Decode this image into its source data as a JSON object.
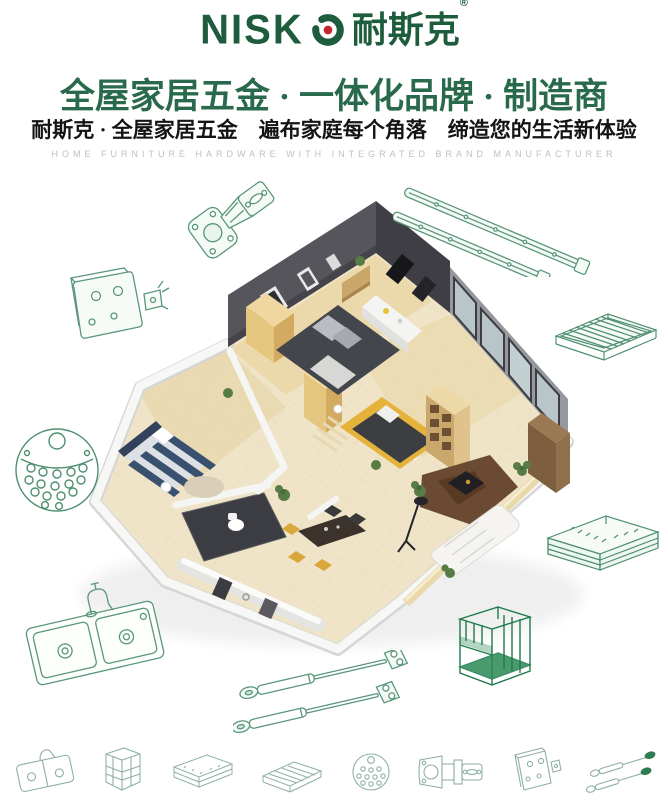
{
  "brand": {
    "logo_letters": "NISK",
    "logo_text": "NISKO",
    "logo_cn": "耐斯克",
    "registered_mark": "®",
    "logo_color": "#1d5c3c",
    "logo_dot_color": "#c1272d"
  },
  "header": {
    "headline": "全屋家居五金 · 一体化品牌 · 制造商",
    "subheadline": "耐斯克 · 全屋家居五金　遍布家庭每个角落　缔造您的生活新体验",
    "tagline": "HOME FURNITURE HARDWARE WITH INTEGRATED BRAND MANUFACTURER",
    "headline_color": "#2a6a4c"
  },
  "illustrations": {
    "line_art_color": "#5a967c",
    "line_art_dark_color": "#1e7a4b",
    "scene": "apartment-3d-cutaway-render",
    "around_scene_icons": [
      "cabinet-hinge-icon",
      "drawer-slides-icon",
      "mounting-bracket-icon",
      "perforated-disc-icon",
      "kitchen-sink-icon",
      "wire-shelf-icon",
      "pullout-basket-icon",
      "wire-rack-organizer-icon",
      "gas-struts-icon"
    ],
    "bottom_row_icons": [
      "sink-mini-icon",
      "cabinet-frame-mini-icon",
      "basket-mini-icon",
      "shelf-mini-icon",
      "disc-mini-icon",
      "hinge-mini-icon",
      "bracket-mini-icon",
      "struts-mini-icon"
    ]
  }
}
